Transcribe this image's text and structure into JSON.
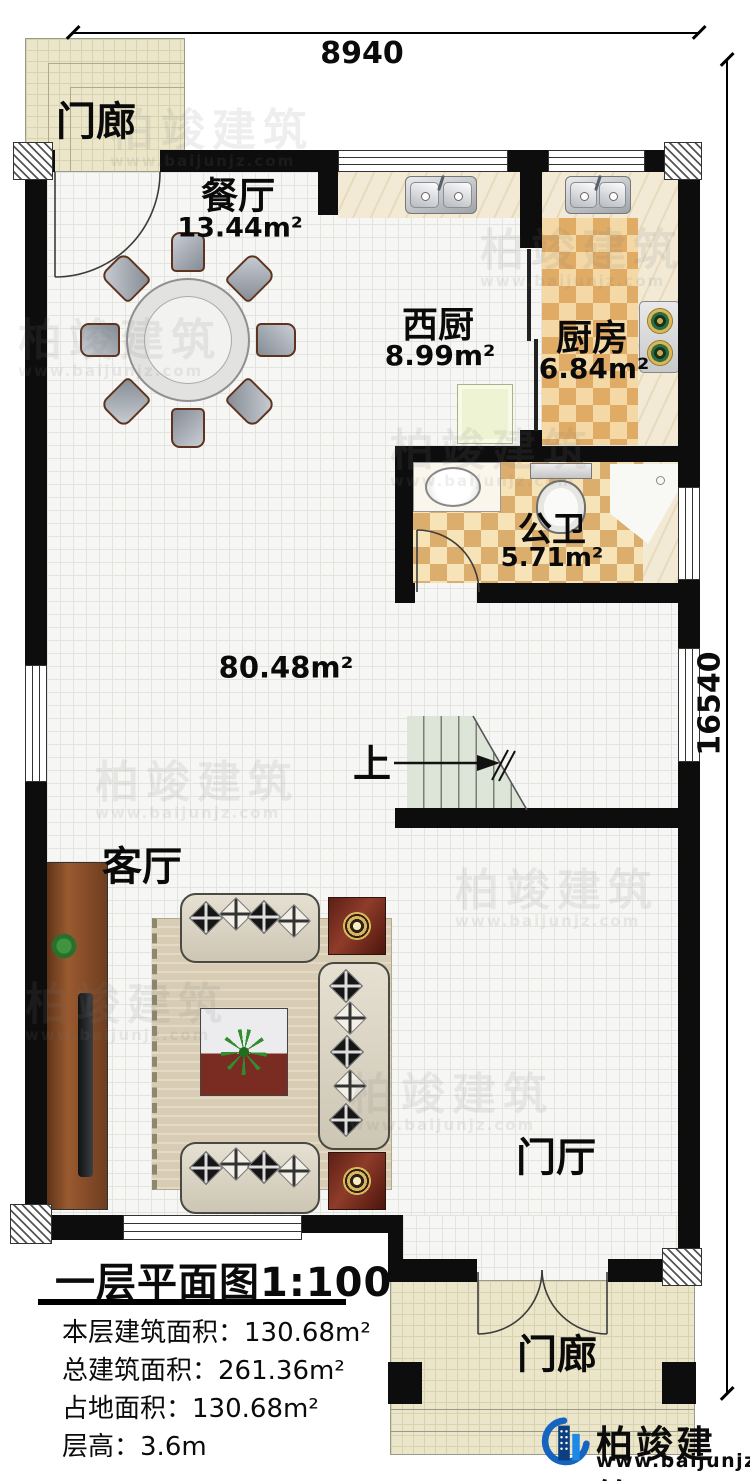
{
  "dimensions": {
    "width_label": "8940",
    "height_label": "16540"
  },
  "rooms": {
    "porch_top": {
      "name": "门廊"
    },
    "dining": {
      "name": "餐厅",
      "area": "13.44m²"
    },
    "west_kitchen": {
      "name": "西厨",
      "area": "8.99m²"
    },
    "kitchen": {
      "name": "厨房",
      "area": "6.84m²"
    },
    "bathroom": {
      "name": "公卫",
      "area": "5.71m²"
    },
    "great_room": {
      "area": "80.48m²"
    },
    "stairs": {
      "direction_label": "上"
    },
    "living": {
      "name": "客厅"
    },
    "foyer": {
      "name": "门厅"
    },
    "porch_bottom": {
      "name": "门廊"
    }
  },
  "info_block": {
    "title": "一层平面图1:100",
    "rows": [
      {
        "label": "本层建筑面积：",
        "value": "130.68m²"
      },
      {
        "label": "总建筑面积：",
        "value": "261.36m²"
      },
      {
        "label": "占地面积：",
        "value": "130.68m²"
      },
      {
        "label": "层高：",
        "value": "3.6m"
      }
    ]
  },
  "logo": {
    "name": "柏竣建筑",
    "url": "www.baijunjz.com",
    "brand_color": "#1565c0"
  },
  "watermark": {
    "text": "柏竣建筑",
    "url": "www.baijunjz.com"
  }
}
